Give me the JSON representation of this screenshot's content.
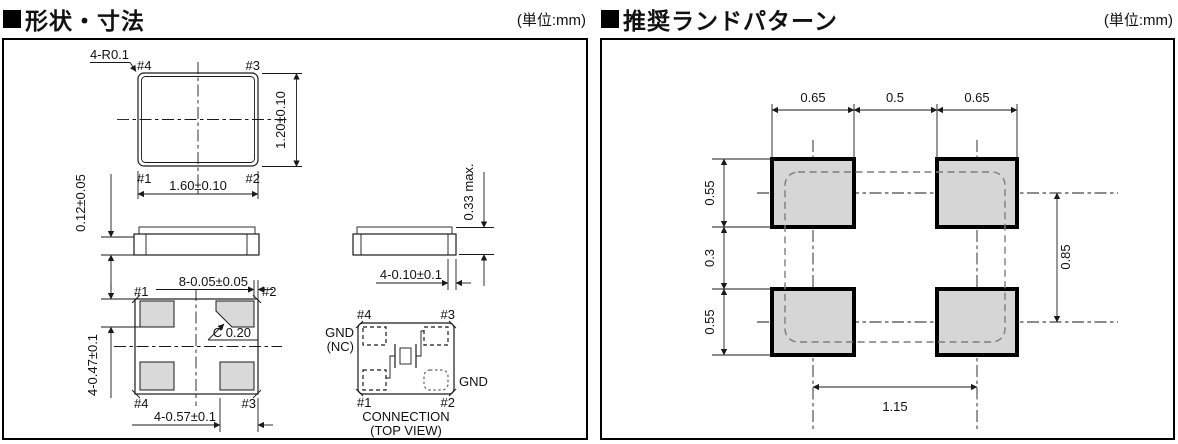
{
  "left_panel": {
    "title": "形状・寸法",
    "unit": "(単位:mm)",
    "top_view": {
      "corner_radius_note": "4-R0.1",
      "pin_tl": "#4",
      "pin_tr": "#3",
      "pin_bl": "#1",
      "pin_br": "#2",
      "width_dim": "1.60±0.10",
      "height_dim": "1.20±0.10"
    },
    "side_view": {
      "electrode_thickness_dim": "0.12±0.05"
    },
    "bottom_view": {
      "pin_tl": "#1",
      "pin_tr": "#2",
      "pin_bl": "#4",
      "pin_br": "#3",
      "pad_inset_dim": "8-0.05±0.05",
      "chamfer_note": "C 0.20",
      "pad_height_dim": "4-0.47±0.1",
      "pad_width_dim": "4-0.57±0.1"
    },
    "end_view": {
      "height_dim": "0.33 max.",
      "terminal_dim": "4-0.10±0.1"
    },
    "connection_view": {
      "pin_tl": "#4",
      "pin_tr": "#3",
      "pin_bl": "#1",
      "pin_br": "#2",
      "label_left_line1": "GND",
      "label_left_line2": "(NC)",
      "label_right": "GND",
      "caption_line1": "CONNECTION",
      "caption_line2": "(TOP VIEW)"
    }
  },
  "right_panel": {
    "title": "推奨ランドパターン",
    "unit": "(単位:mm)",
    "dims": {
      "pad_width_left": "0.65",
      "pad_gap_x": "0.5",
      "pad_width_right": "0.65",
      "pad_height_top": "0.55",
      "pad_gap_y": "0.3",
      "pad_height_bottom": "0.55",
      "pitch_y": "0.85",
      "pitch_x": "1.15"
    }
  },
  "colors": {
    "line": "#1a1a1a",
    "pad_fill": "#d9d9d9",
    "land_pad_fill": "#d6d6d6",
    "background": "#ffffff"
  }
}
